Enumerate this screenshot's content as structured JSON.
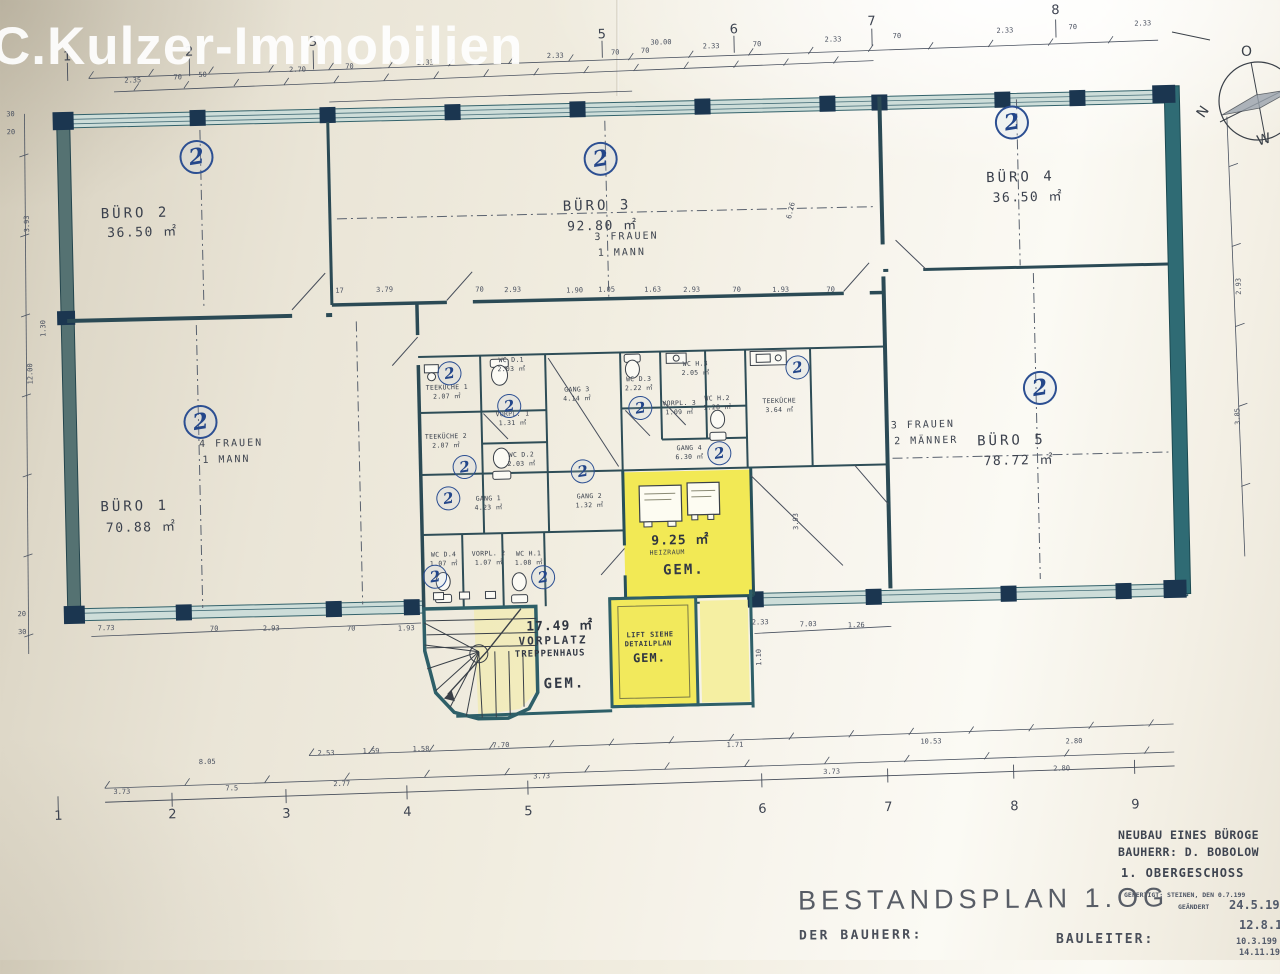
{
  "watermark": "C.Kulzer-Immobilien",
  "compass": {
    "o": "O",
    "n": "N",
    "w": "W"
  },
  "rooms": {
    "buero1": {
      "name": "BÜRO 1",
      "area": "70.88 ㎡",
      "note1": "4 FRAUEN",
      "note2": "1 MANN"
    },
    "buero2": {
      "name": "BÜRO 2",
      "area": "36.50 ㎡"
    },
    "buero3": {
      "name": "BÜRO 3",
      "area": "92.80 ㎡",
      "note1": "3 FRAUEN",
      "note2": "1 MANN"
    },
    "buero4": {
      "name": "BÜRO 4",
      "area": "36.50 ㎡"
    },
    "buero5": {
      "name": "BÜRO 5",
      "area": "78.72 ㎡",
      "note1": "3 FRAUEN",
      "note2": "2 MÄNNER"
    },
    "heizraum": {
      "area": "9.25 ㎡",
      "name": "HEIZRAUM",
      "gem": "GEM."
    },
    "vorplatz": {
      "area": "17.49 ㎡",
      "line1": "VORPLATZ",
      "line2": "TREPPENHAUS",
      "gem": "GEM."
    },
    "lift": {
      "line1": "LIFT SIEHE",
      "line2": "DETAILPLAN",
      "gem": "GEM."
    }
  },
  "plan_labels": [
    {
      "t": "TEEKÜCHE 1",
      "x": 446,
      "y": 383
    },
    {
      "t": "2.07 ㎡",
      "x": 446,
      "y": 391
    },
    {
      "t": "TEEKÜCHE 2",
      "x": 444,
      "y": 432
    },
    {
      "t": "2.07 ㎡",
      "x": 444,
      "y": 440
    },
    {
      "t": "WC D.1",
      "x": 511,
      "y": 357
    },
    {
      "t": "2.03 ㎡",
      "x": 511,
      "y": 365
    },
    {
      "t": "VORPL. 1",
      "x": 511,
      "y": 411
    },
    {
      "t": "1.31 ㎡",
      "x": 511,
      "y": 419
    },
    {
      "t": "WC D.2",
      "x": 519,
      "y": 452
    },
    {
      "t": "2.03 ㎡",
      "x": 519,
      "y": 460
    },
    {
      "t": "GANG 3",
      "x": 576,
      "y": 388
    },
    {
      "t": "4.14 ㎡",
      "x": 576,
      "y": 396
    },
    {
      "t": "WC D.3",
      "x": 638,
      "y": 379
    },
    {
      "t": "2.22 ㎡",
      "x": 638,
      "y": 387
    },
    {
      "t": "WC H.3",
      "x": 695,
      "y": 365
    },
    {
      "t": "2.05 ㎡",
      "x": 695,
      "y": 373
    },
    {
      "t": "VORPL. 3",
      "x": 678,
      "y": 404
    },
    {
      "t": "1.09 ㎡",
      "x": 678,
      "y": 412
    },
    {
      "t": "WC H.2",
      "x": 716,
      "y": 400
    },
    {
      "t": "1.28 ㎡",
      "x": 716,
      "y": 408
    },
    {
      "t": "TEEKÜCHE",
      "x": 778,
      "y": 404
    },
    {
      "t": "3.64 ㎡",
      "x": 778,
      "y": 412
    },
    {
      "t": "GANG 4",
      "x": 687,
      "y": 449
    },
    {
      "t": "6.30 ㎡",
      "x": 687,
      "y": 457
    },
    {
      "t": "GANG 1",
      "x": 485,
      "y": 495
    },
    {
      "t": "4.23 ㎡",
      "x": 485,
      "y": 503
    },
    {
      "t": "GANG 2",
      "x": 586,
      "y": 495
    },
    {
      "t": "1.32 ㎡",
      "x": 586,
      "y": 503
    },
    {
      "t": "WC D.4",
      "x": 439,
      "y": 550
    },
    {
      "t": "1.07 ㎡",
      "x": 439,
      "y": 558
    },
    {
      "t": "VORPL. 2",
      "x": 484,
      "y": 550
    },
    {
      "t": "1.07 ㎡",
      "x": 484,
      "y": 558
    },
    {
      "t": "WC H.1",
      "x": 524,
      "y": 551
    },
    {
      "t": "1.08 ㎡",
      "x": 524,
      "y": 559
    }
  ],
  "dims": [
    {
      "t": "2.35",
      "x": 139,
      "y": 69
    },
    {
      "t": "70",
      "x": 184,
      "y": 67
    },
    {
      "t": "50",
      "x": 209,
      "y": 65
    },
    {
      "t": "2.70",
      "x": 304,
      "y": 62
    },
    {
      "t": "70",
      "x": 356,
      "y": 60
    },
    {
      "t": "2.33",
      "x": 432,
      "y": 58
    },
    {
      "t": "2.33",
      "x": 562,
      "y": 54
    },
    {
      "t": "70",
      "x": 622,
      "y": 52
    },
    {
      "t": "30.00",
      "x": 668,
      "y": 43
    },
    {
      "t": "70",
      "x": 652,
      "y": 51
    },
    {
      "t": "2.33",
      "x": 718,
      "y": 48
    },
    {
      "t": "70",
      "x": 764,
      "y": 47
    },
    {
      "t": "2.33",
      "x": 840,
      "y": 44
    },
    {
      "t": "70",
      "x": 904,
      "y": 42
    },
    {
      "t": "2.33",
      "x": 1012,
      "y": 39
    },
    {
      "t": "70",
      "x": 1080,
      "y": 37
    },
    {
      "t": "2.33",
      "x": 1150,
      "y": 35
    },
    {
      "t": "17",
      "x": 341,
      "y": 284
    },
    {
      "t": "3.79",
      "x": 386,
      "y": 284
    },
    {
      "t": "70",
      "x": 481,
      "y": 286
    },
    {
      "t": "2.93",
      "x": 514,
      "y": 287
    },
    {
      "t": "1.90",
      "x": 576,
      "y": 289
    },
    {
      "t": "1.05",
      "x": 608,
      "y": 289
    },
    {
      "t": "1.63",
      "x": 654,
      "y": 290
    },
    {
      "t": "2.93",
      "x": 693,
      "y": 291
    },
    {
      "t": "70",
      "x": 738,
      "y": 292
    },
    {
      "t": "1.93",
      "x": 782,
      "y": 293
    },
    {
      "t": "70",
      "x": 832,
      "y": 294
    },
    {
      "t": "7.73",
      "x": 100,
      "y": 616
    },
    {
      "t": "70",
      "x": 208,
      "y": 619
    },
    {
      "t": "2.93",
      "x": 265,
      "y": 620
    },
    {
      "t": "70",
      "x": 345,
      "y": 622
    },
    {
      "t": "1.93",
      "x": 400,
      "y": 623
    },
    {
      "t": "2.33",
      "x": 754,
      "y": 625
    },
    {
      "t": "7.03",
      "x": 802,
      "y": 628
    },
    {
      "t": "1.26",
      "x": 850,
      "y": 630
    },
    {
      "t": "8.05",
      "x": 198,
      "y": 752
    },
    {
      "t": "2.53",
      "x": 317,
      "y": 746
    },
    {
      "t": "1.59",
      "x": 362,
      "y": 745
    },
    {
      "t": "1.58",
      "x": 412,
      "y": 744
    },
    {
      "t": "7.70",
      "x": 492,
      "y": 742
    },
    {
      "t": "1.71",
      "x": 726,
      "y": 747
    },
    {
      "t": "10.53",
      "x": 922,
      "y": 748
    },
    {
      "t": "2.80",
      "x": 1065,
      "y": 751
    },
    {
      "t": "3.73",
      "x": 112,
      "y": 780
    },
    {
      "t": "7.5",
      "x": 222,
      "y": 779
    },
    {
      "t": "2.77",
      "x": 332,
      "y": 777
    },
    {
      "t": "3.73",
      "x": 532,
      "y": 774
    },
    {
      "t": "3.73",
      "x": 822,
      "y": 776
    },
    {
      "t": "2.80",
      "x": 1052,
      "y": 778
    },
    {
      "t": "30",
      "x": 16,
      "y": 100
    },
    {
      "t": "20",
      "x": 16,
      "y": 118
    },
    {
      "t": "3.93",
      "x": 30,
      "y": 210,
      "r": -90
    },
    {
      "t": "1.30",
      "x": 44,
      "y": 315,
      "r": -90
    },
    {
      "t": "12.00",
      "x": 30,
      "y": 360,
      "r": -90
    },
    {
      "t": "20",
      "x": 16,
      "y": 600
    },
    {
      "t": "30",
      "x": 16,
      "y": 618
    },
    {
      "t": "6.26",
      "x": 794,
      "y": 214,
      "r": -75
    },
    {
      "t": "3.93",
      "x": 792,
      "y": 525,
      "r": -90
    },
    {
      "t": "1.10",
      "x": 752,
      "y": 660,
      "r": -90
    },
    {
      "t": "2.93",
      "x": 1240,
      "y": 300,
      "r": -90
    },
    {
      "t": "3.85",
      "x": 1236,
      "y": 430,
      "r": -90
    }
  ],
  "grid_top": [
    {
      "t": "1",
      "x": 74,
      "y": 44
    },
    {
      "t": "2",
      "x": 196,
      "y": 42
    },
    {
      "t": "3",
      "x": 320,
      "y": 35
    },
    {
      "t": "5",
      "x": 609,
      "y": 34
    },
    {
      "t": "6",
      "x": 741,
      "y": 32
    },
    {
      "t": "7",
      "x": 879,
      "y": 27
    },
    {
      "t": "8",
      "x": 1063,
      "y": 20
    }
  ],
  "grid_bottom": [
    {
      "t": "1",
      "x": 48,
      "y": 803
    },
    {
      "t": "2",
      "x": 162,
      "y": 804
    },
    {
      "t": "3",
      "x": 276,
      "y": 806
    },
    {
      "t": "4",
      "x": 397,
      "y": 807
    },
    {
      "t": "5",
      "x": 518,
      "y": 809
    },
    {
      "t": "6",
      "x": 752,
      "y": 812
    },
    {
      "t": "7",
      "x": 878,
      "y": 813
    },
    {
      "t": "8",
      "x": 1004,
      "y": 815
    },
    {
      "t": "9",
      "x": 1125,
      "y": 816
    }
  ],
  "stamps": [
    {
      "t": "2",
      "x": 201,
      "y": 147,
      "big": 1
    },
    {
      "t": "2",
      "x": 605,
      "y": 158,
      "big": 1
    },
    {
      "t": "2",
      "x": 1017,
      "y": 131,
      "big": 1
    },
    {
      "t": "2",
      "x": 199,
      "y": 412,
      "big": 1
    },
    {
      "t": "2",
      "x": 1039,
      "y": 397,
      "big": 1
    },
    {
      "t": "2",
      "x": 449,
      "y": 369
    },
    {
      "t": "2",
      "x": 508,
      "y": 403
    },
    {
      "t": "2",
      "x": 462,
      "y": 463
    },
    {
      "t": "2",
      "x": 445,
      "y": 494
    },
    {
      "t": "2",
      "x": 580,
      "y": 470
    },
    {
      "t": "2",
      "x": 717,
      "y": 455
    },
    {
      "t": "2",
      "x": 797,
      "y": 371
    },
    {
      "t": "2",
      "x": 639,
      "y": 408
    },
    {
      "t": "2",
      "x": 430,
      "y": 572
    },
    {
      "t": "2",
      "x": 538,
      "y": 575
    }
  ],
  "title_block": {
    "project": "NEUBAU EINES BÜROGE",
    "client": "BAUHERR: D. BOBOLOW",
    "floor": "1. OBERGESCHOSS",
    "made": "GEFERTIGT:   STEINEN, DEN 0.7.199",
    "changed": "GEÄNDERT",
    "dates": [
      "24.5.199",
      "12.8.19",
      "10.3.199",
      "14.11.19"
    ],
    "plan_title": "BESTANDSPLAN 1.OG",
    "owner_label": "DER BAUHERR:",
    "manager_label": "BAULEITER:"
  }
}
